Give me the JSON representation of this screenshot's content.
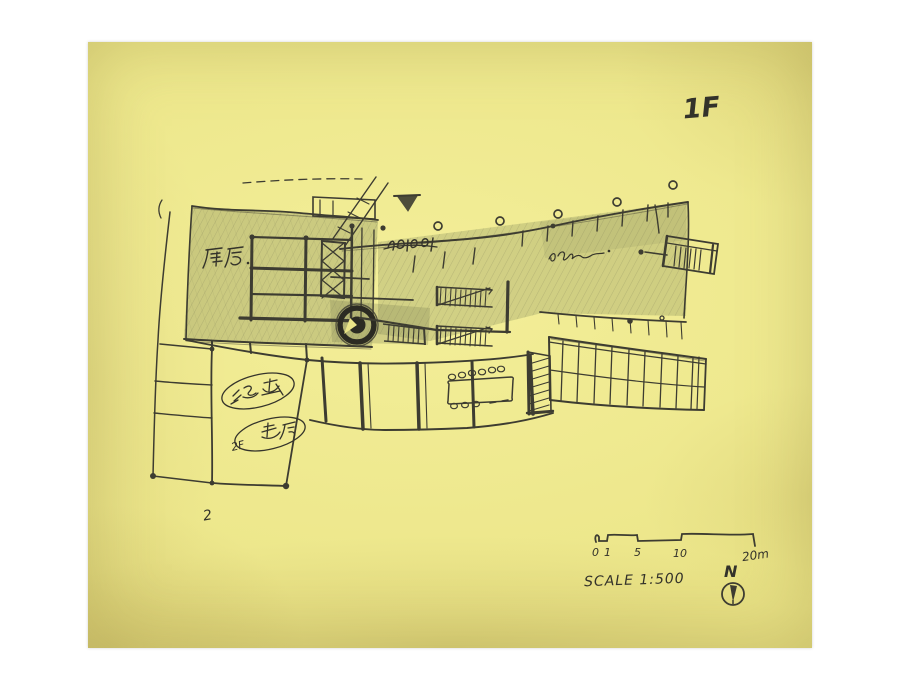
{
  "colors": {
    "paper": "#ebe588",
    "ink": "#3d3c31",
    "pencil_shading": "#979a63"
  },
  "floor_label": "1F",
  "annotations": {
    "kitchen_label": "厨房",
    "crossed_scribble": "ROD",
    "cursive_scribble": "show",
    "oval_top_label": "溪子厅",
    "oval_bottom_prefix": "2F",
    "oval_bottom_label": "着厅",
    "small_number": "2"
  },
  "scale_bar": {
    "tick_labels": [
      "0",
      "1",
      "5",
      "10"
    ],
    "end_label": "20m",
    "caption": "SCALE 1:500"
  },
  "compass": {
    "label": "N"
  }
}
